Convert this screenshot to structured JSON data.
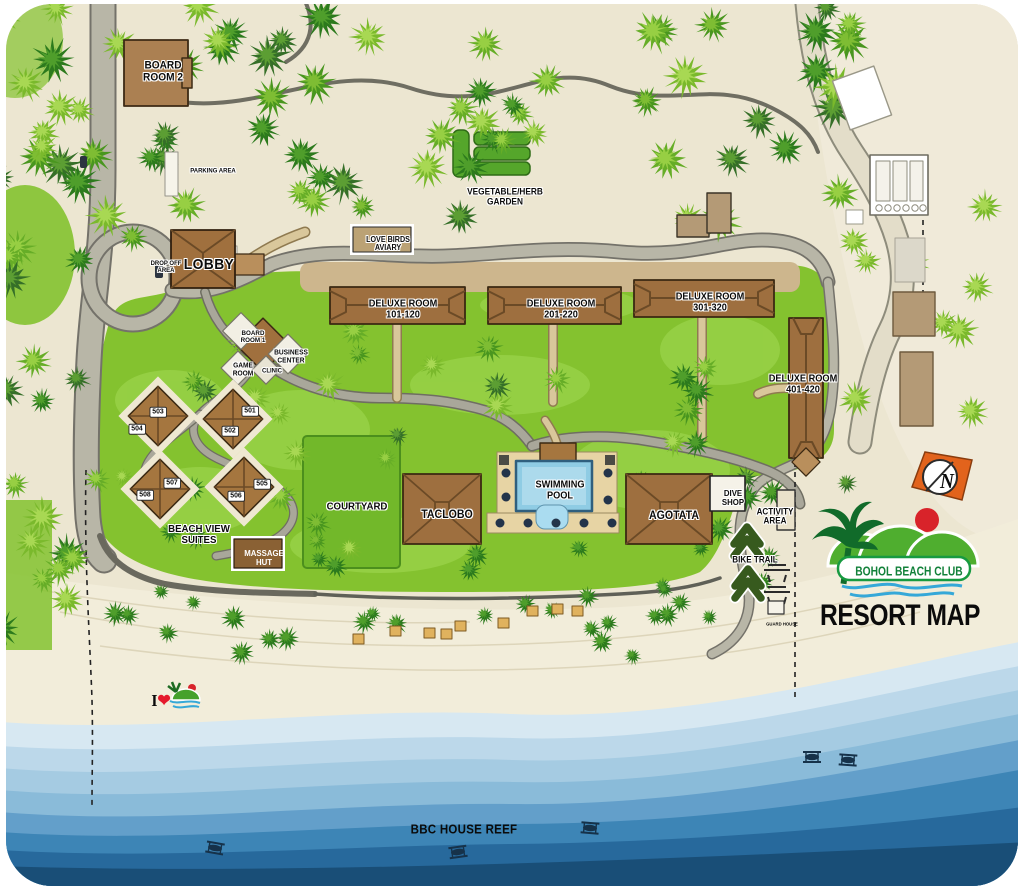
{
  "map_title": "RESORT MAP",
  "brand": {
    "name": "BOHOL BEACH CLUB"
  },
  "compass": {
    "label": "N"
  },
  "ocean": {
    "reef_label": "BBC HOUSE REEF"
  },
  "beach_mark": {
    "prefix": "I",
    "heart": "❤"
  },
  "places": {
    "board_room_2": {
      "lines": [
        "BOARD",
        "ROOM 2"
      ]
    },
    "parking_area": {
      "label": "PARKING AREA"
    },
    "drop_off_area": {
      "lines": [
        "DROP OFF",
        "AREA"
      ]
    },
    "lobby": {
      "label": "LOBBY"
    },
    "board_room_1": {
      "lines": [
        "BOARD",
        "ROOM 1"
      ]
    },
    "business_center": {
      "lines": [
        "BUSINESS",
        "CENTER"
      ]
    },
    "game_room": {
      "lines": [
        "GAME",
        "ROOM"
      ]
    },
    "clinic": {
      "label": "CLINIC"
    },
    "love_birds_aviary": {
      "lines": [
        "LOVE BIRDS",
        "AVIARY"
      ]
    },
    "vegetable_herb_garden": {
      "lines": [
        "VEGETABLE/HERB",
        "GARDEN"
      ]
    },
    "courtyard": {
      "label": "COURTYARD"
    },
    "taclobo": {
      "label": "TACLOBO"
    },
    "swimming_pool": {
      "lines": [
        "SWIMMING",
        "POOL"
      ]
    },
    "agotata": {
      "label": "AGOTATA"
    },
    "dive_shop": {
      "lines": [
        "DIVE",
        "SHOP"
      ]
    },
    "activity_area": {
      "lines": [
        "ACTIVITY",
        "AREA"
      ]
    },
    "bike_trail": {
      "label": "BIKE TRAIL"
    },
    "guard_house": {
      "label": "GUARD HOUSE"
    },
    "massage_hut": {
      "lines": [
        "MASSAGE",
        "HUT"
      ]
    },
    "beach_view_suites": {
      "label_lines": [
        "BEACH VIEW",
        "SUITES"
      ],
      "units": [
        "501",
        "502",
        "503",
        "504",
        "505",
        "506",
        "507",
        "508"
      ]
    },
    "deluxe_rooms": [
      {
        "name": "DELUXE ROOM",
        "range": "101-120"
      },
      {
        "name": "DELUXE ROOM",
        "range": "201-220"
      },
      {
        "name": "DELUXE ROOM",
        "range": "301-320"
      },
      {
        "name": "DELUXE ROOM",
        "range": "401-420"
      }
    ]
  },
  "colors": {
    "land": "#ece6d1",
    "beach": "#f2edda",
    "grass": "#84c22f",
    "road": "#b8b6a7",
    "walkway": "#d9c79b",
    "building": "#9e6f3f",
    "pool_water": "#8fcce4",
    "ocean_dark": "#194e77",
    "logo_green": "#3aa433",
    "compass_orange": "#e2631c",
    "heart_red": "#e51a2c"
  }
}
